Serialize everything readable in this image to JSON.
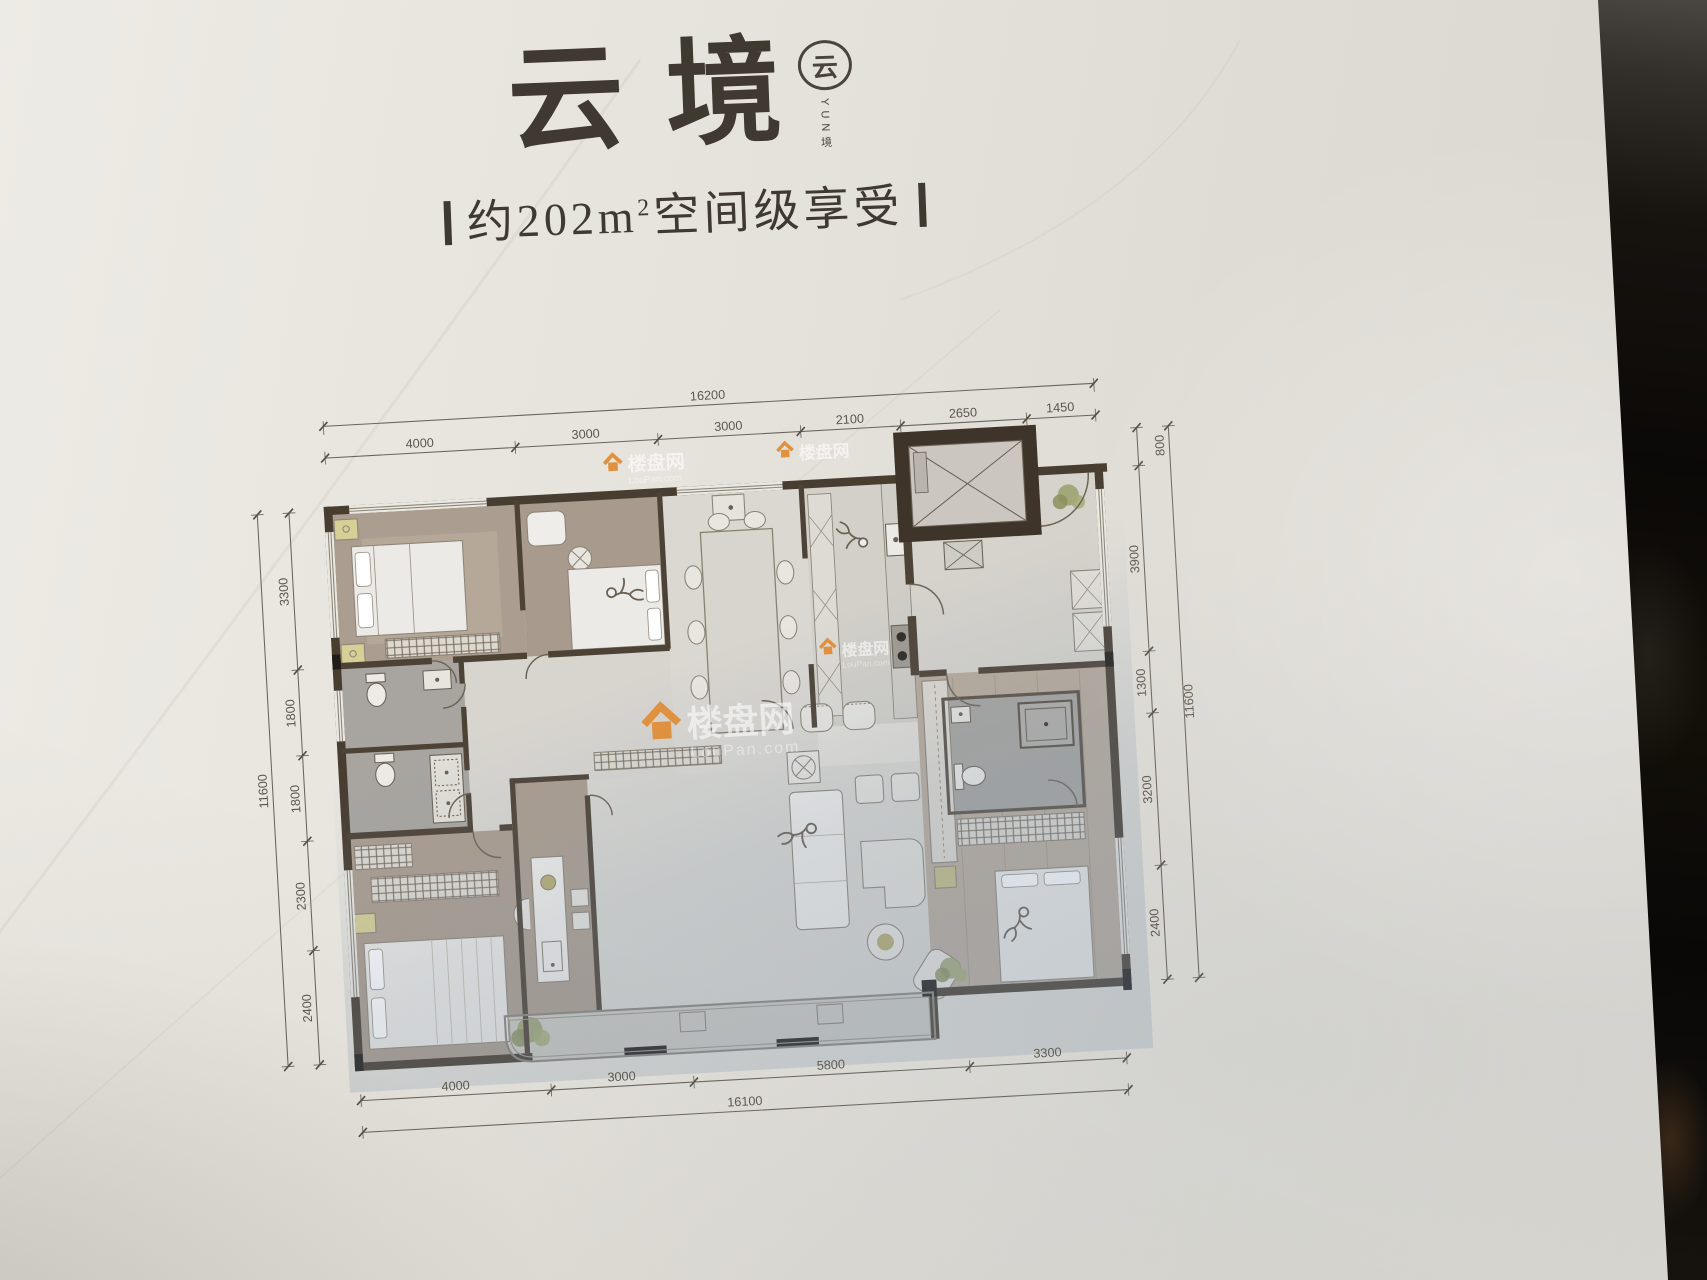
{
  "header": {
    "title": "云境",
    "logo": {
      "symbol": "云",
      "caption": "YUN境"
    },
    "subtitle": {
      "prefix": "约202",
      "unit": "m",
      "power": "2",
      "suffix": "空间级享受"
    }
  },
  "floor_plan": {
    "dims": {
      "top": {
        "total": "16200",
        "segments": [
          "4000",
          "3000",
          "3000",
          "2100",
          "2650",
          "1450"
        ]
      },
      "bottom": {
        "total": "16100",
        "segments": [
          "4000",
          "3000",
          "5800",
          "3300"
        ]
      },
      "left": {
        "total": "11600",
        "segments": [
          "3300",
          "1800",
          "1800",
          "2300",
          "2400"
        ]
      },
      "right": {
        "total": "11600",
        "segments": [
          "800",
          "3900",
          "1300",
          "3200",
          "2400"
        ]
      }
    },
    "watermark": {
      "brand": "楼盘网",
      "domain": "LouPan.com"
    }
  },
  "colors": {
    "paper": "#e6e2db",
    "wall_dark": "#483d31",
    "floor_warm": "#ab9d8f",
    "floor_marble": "#d9d6d0",
    "accent_yellow": "#d6cf96",
    "watermark_orange": "#e0913f",
    "photo_edge_dark": "#0c0a08"
  }
}
